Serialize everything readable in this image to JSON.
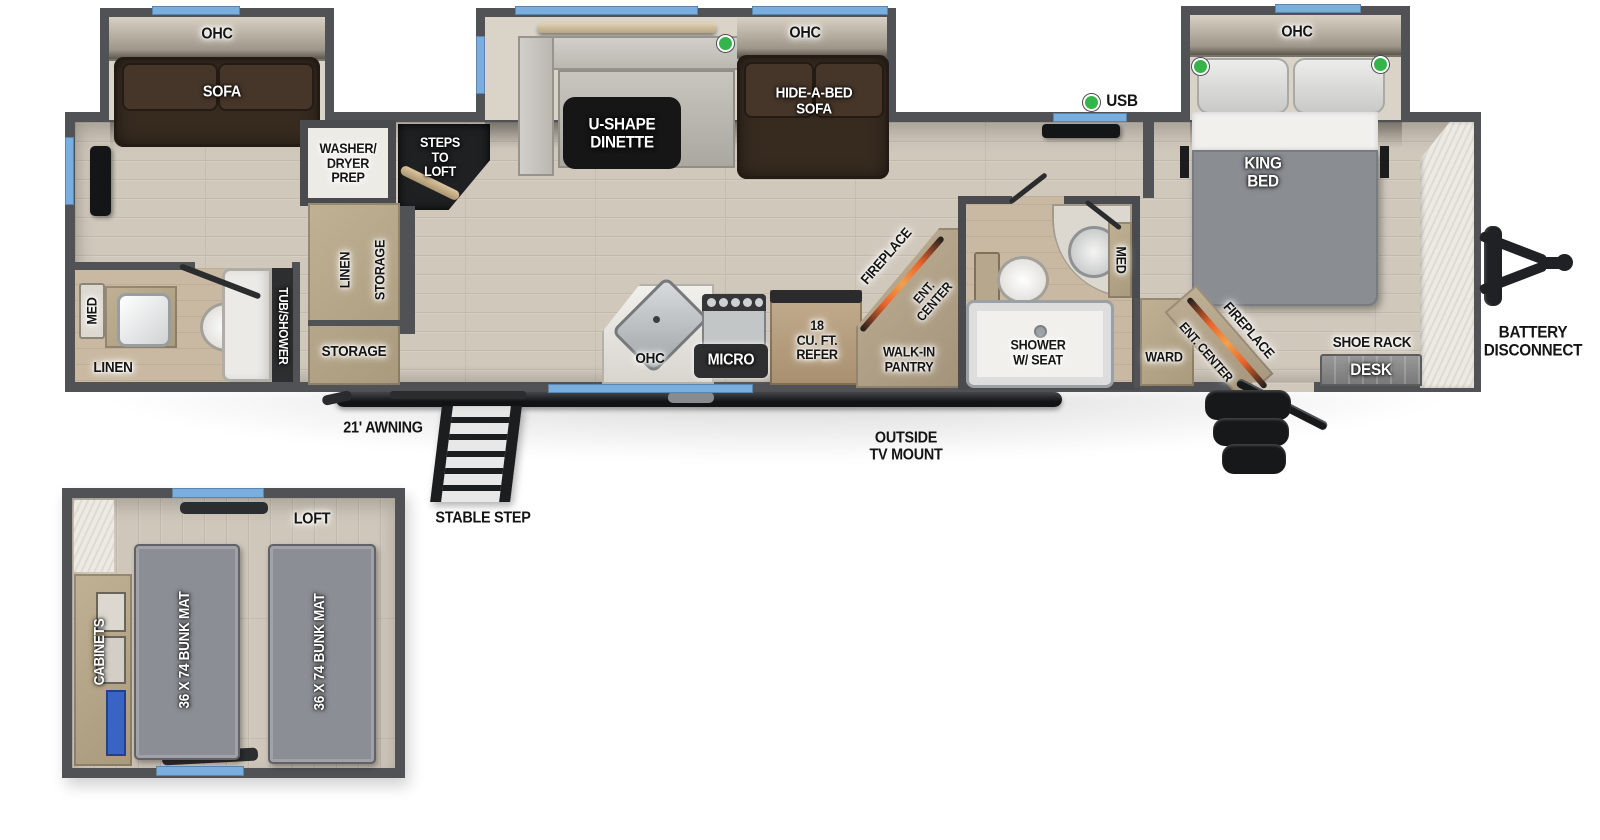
{
  "slides": {
    "rear_sofa": {
      "ohc": "OHC",
      "sofa": "SOFA"
    },
    "dinette": {
      "ohc": "OHC",
      "table": "U-SHAPE\nDINETTE",
      "hide_a_bed": "HIDE-A-BED\nSOFA"
    },
    "king": {
      "ohc": "OHC",
      "bed": "KING\nBED"
    }
  },
  "living": {
    "usb": "USB",
    "washer_dryer": "WASHER/\nDRYER\nPREP",
    "steps_to_loft": "STEPS\nTO\nLOFT",
    "linen_closet": "LINEN",
    "storage_closet": "STORAGE",
    "storage_room": "STORAGE"
  },
  "rear_bath": {
    "med": "MED",
    "linen": "LINEN",
    "tub_shower": "TUB/SHOWER"
  },
  "kitchen": {
    "ohc": "OHC",
    "micro": "MICRO",
    "refer": "18\nCU. FT.\nREFER",
    "fireplace": "FIREPLACE",
    "ent_center": "ENT.\nCENTER",
    "pantry": "WALK-IN\nPANTRY"
  },
  "mid_bath": {
    "shower": "SHOWER\nW/ SEAT",
    "med": "MED"
  },
  "bedroom": {
    "ward": "WARD",
    "ent_center": "ENT. CENTER",
    "fireplace": "FIREPLACE",
    "shoe_rack": "SHOE RACK",
    "desk": "DESK"
  },
  "exterior": {
    "awning": "21' AWNING",
    "stable_step": "STABLE STEP",
    "outside_tv": "OUTSIDE\nTV MOUNT",
    "battery": "BATTERY\nDISCONNECT"
  },
  "loft": {
    "title": "LOFT",
    "bunk_left": "36 X 74 BUNK MAT",
    "bunk_right": "36 X 74 BUNK MAT",
    "cabinets": "CABINETS"
  },
  "colors": {
    "window": "#79aede",
    "usb_dot": "#35b44a",
    "fireplace_accent": "#e8632a",
    "wall": "#515256"
  }
}
